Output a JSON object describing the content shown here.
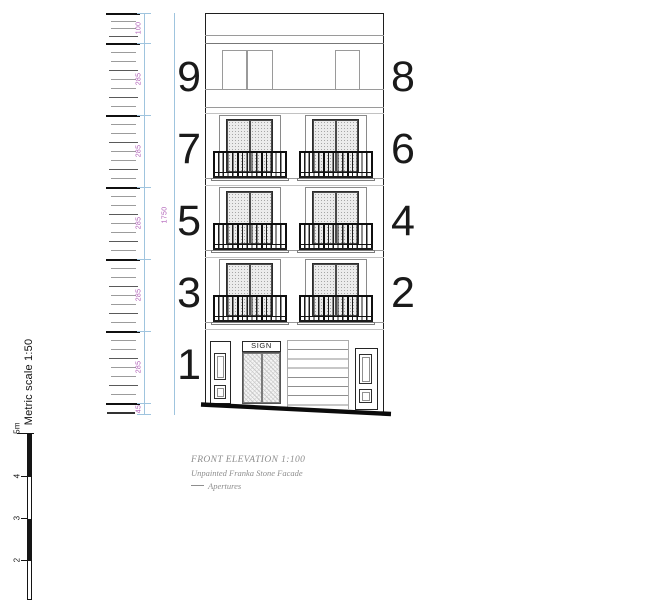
{
  "drawing": {
    "floor_numbers_left": [
      "9",
      "7",
      "5",
      "3",
      "1"
    ],
    "floor_numbers_right": [
      "8",
      "6",
      "4",
      "2"
    ],
    "sign_label": "SIGN",
    "overall_dimension_label": "1750",
    "dimension_segment_labels": [
      "100",
      "285",
      "285",
      "285",
      "285",
      "285",
      "45"
    ],
    "title": "FRONT ELEVATION 1:100",
    "material_note": "Unpainted Franka Stone Facade",
    "legend_aperture_label": "Apertures",
    "metric_scale_label": "Metric scale 1:50",
    "scale_bar_labels": [
      "5m",
      "4",
      "3",
      "2"
    ],
    "colors": {
      "dimension_line": "#9fc4de",
      "dimension_text": "#b060b8",
      "outline": "#1f1f1f",
      "band_line": "#9a9a9a",
      "light_line": "#c2c2c2",
      "annotation_text": "#8e8e8e"
    }
  }
}
